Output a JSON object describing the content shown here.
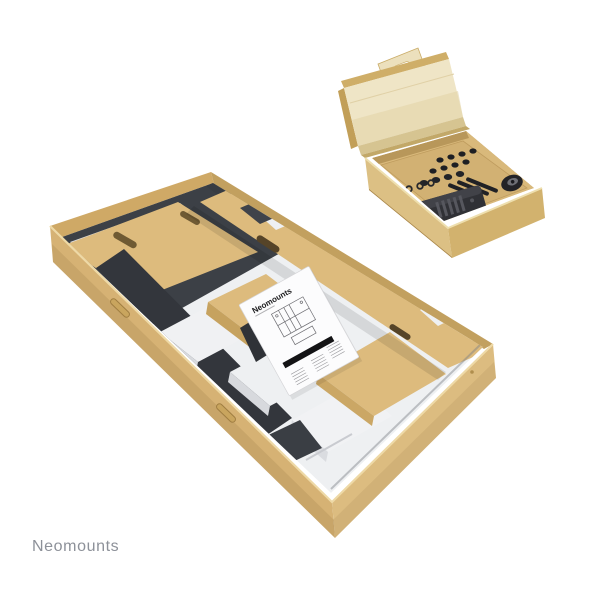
{
  "page": {
    "background": "#ffffff"
  },
  "branding": {
    "watermark": "Neomounts",
    "watermark_color": "#8d9199"
  },
  "main_box": {
    "manual": {
      "brand": "Neomounts"
    }
  },
  "colors": {
    "cardboard": "#d6b274",
    "cardboard_light": "#dcbc80",
    "cardboard_dark": "#c29f58",
    "divider_tan": "#ddbb7d",
    "lid_cream": "#efe5c6",
    "foam_white": "#eef0f2",
    "metal_dark": "#3c4046",
    "hardware_black": "#303136",
    "tray_tan": "#d9b97b"
  }
}
